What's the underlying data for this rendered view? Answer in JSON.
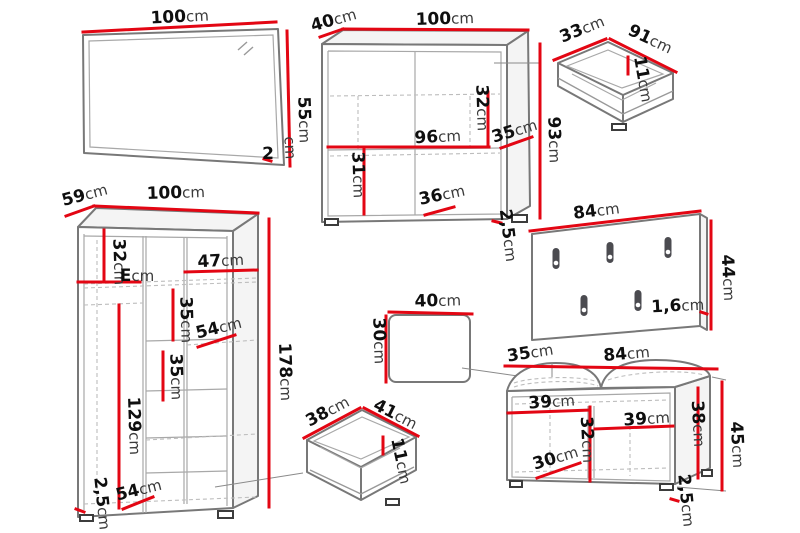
{
  "page": {
    "background": "#ffffff",
    "kind": "furniture-dimensions-diagram"
  },
  "colors": {
    "dimension_line": "#e30613",
    "outline": "#787878",
    "inner_line": "#a8a8a8",
    "hidden_line": "#bdbdbd",
    "number_text": "#0f0f0f",
    "unit_text": "#3a3a3a",
    "hook": "#4b4b50"
  },
  "unit": "cm",
  "pieces": {
    "mirror": {
      "width": {
        "v": "100",
        "u": "cm"
      },
      "height": {
        "v": "55",
        "u": "cm"
      },
      "thickness": {
        "v": "2",
        "u": "cm"
      }
    },
    "sideboard": {
      "depth": {
        "v": "40",
        "u": "cm"
      },
      "width": {
        "v": "100",
        "u": "cm"
      },
      "inner_width": {
        "v": "96",
        "u": "cm"
      },
      "inner_right_height": {
        "v": "32",
        "u": "cm"
      },
      "inner_left_height": {
        "v": "31",
        "u": "cm"
      },
      "bottom_width": {
        "v": "36",
        "u": "cm"
      },
      "side_depth": {
        "v": "35",
        "u": "cm"
      },
      "height": {
        "v": "93",
        "u": "cm"
      },
      "plinth": {
        "v": "2,5",
        "u": "cm"
      }
    },
    "drawer_top": {
      "depth": {
        "v": "33",
        "u": "cm"
      },
      "width": {
        "v": "91",
        "u": "cm"
      },
      "height": {
        "v": "11",
        "u": "cm"
      }
    },
    "coat_rack": {
      "width": {
        "v": "84",
        "u": "cm"
      },
      "height": {
        "v": "44",
        "u": "cm"
      },
      "thickness": {
        "v": "1,6",
        "u": "cm"
      }
    },
    "wardrobe": {
      "depth": {
        "v": "59",
        "u": "cm"
      },
      "width": {
        "v": "100",
        "u": "cm"
      },
      "top_section_height": {
        "v": "32",
        "u": "cm"
      },
      "shelf_depth": {
        "v": "E",
        "u": "cm"
      },
      "shelf_width_top": {
        "v": "47",
        "u": "cm"
      },
      "shelf_gap_upper": {
        "v": "35",
        "u": "cm"
      },
      "shelf_width_mid": {
        "v": "54",
        "u": "cm"
      },
      "shelf_gap_lower": {
        "v": "35",
        "u": "cm"
      },
      "hanging_height": {
        "v": "129",
        "u": "cm"
      },
      "height": {
        "v": "178",
        "u": "cm"
      },
      "plinth": {
        "v": "2,5",
        "u": "cm"
      },
      "shelf_width_bottom": {
        "v": "54",
        "u": "cm"
      }
    },
    "seat_cushion": {
      "width": {
        "v": "40",
        "u": "cm"
      },
      "depth": {
        "v": "30",
        "u": "cm"
      }
    },
    "drawer_bottom": {
      "depth": {
        "v": "38",
        "u": "cm"
      },
      "width": {
        "v": "41",
        "u": "cm"
      },
      "height": {
        "v": "11",
        "u": "cm"
      }
    },
    "bench": {
      "cushion_depth": {
        "v": "35",
        "u": "cm"
      },
      "width": {
        "v": "84",
        "u": "cm"
      },
      "left_compartment_width": {
        "v": "39",
        "u": "cm"
      },
      "right_compartment_width": {
        "v": "39",
        "u": "cm"
      },
      "middle_height": {
        "v": "32",
        "u": "cm"
      },
      "bottom_width": {
        "v": "30",
        "u": "cm"
      },
      "inner_height": {
        "v": "38",
        "u": "cm"
      },
      "plinth": {
        "v": "2,5",
        "u": "cm"
      },
      "height": {
        "v": "45",
        "u": "cm"
      }
    }
  }
}
